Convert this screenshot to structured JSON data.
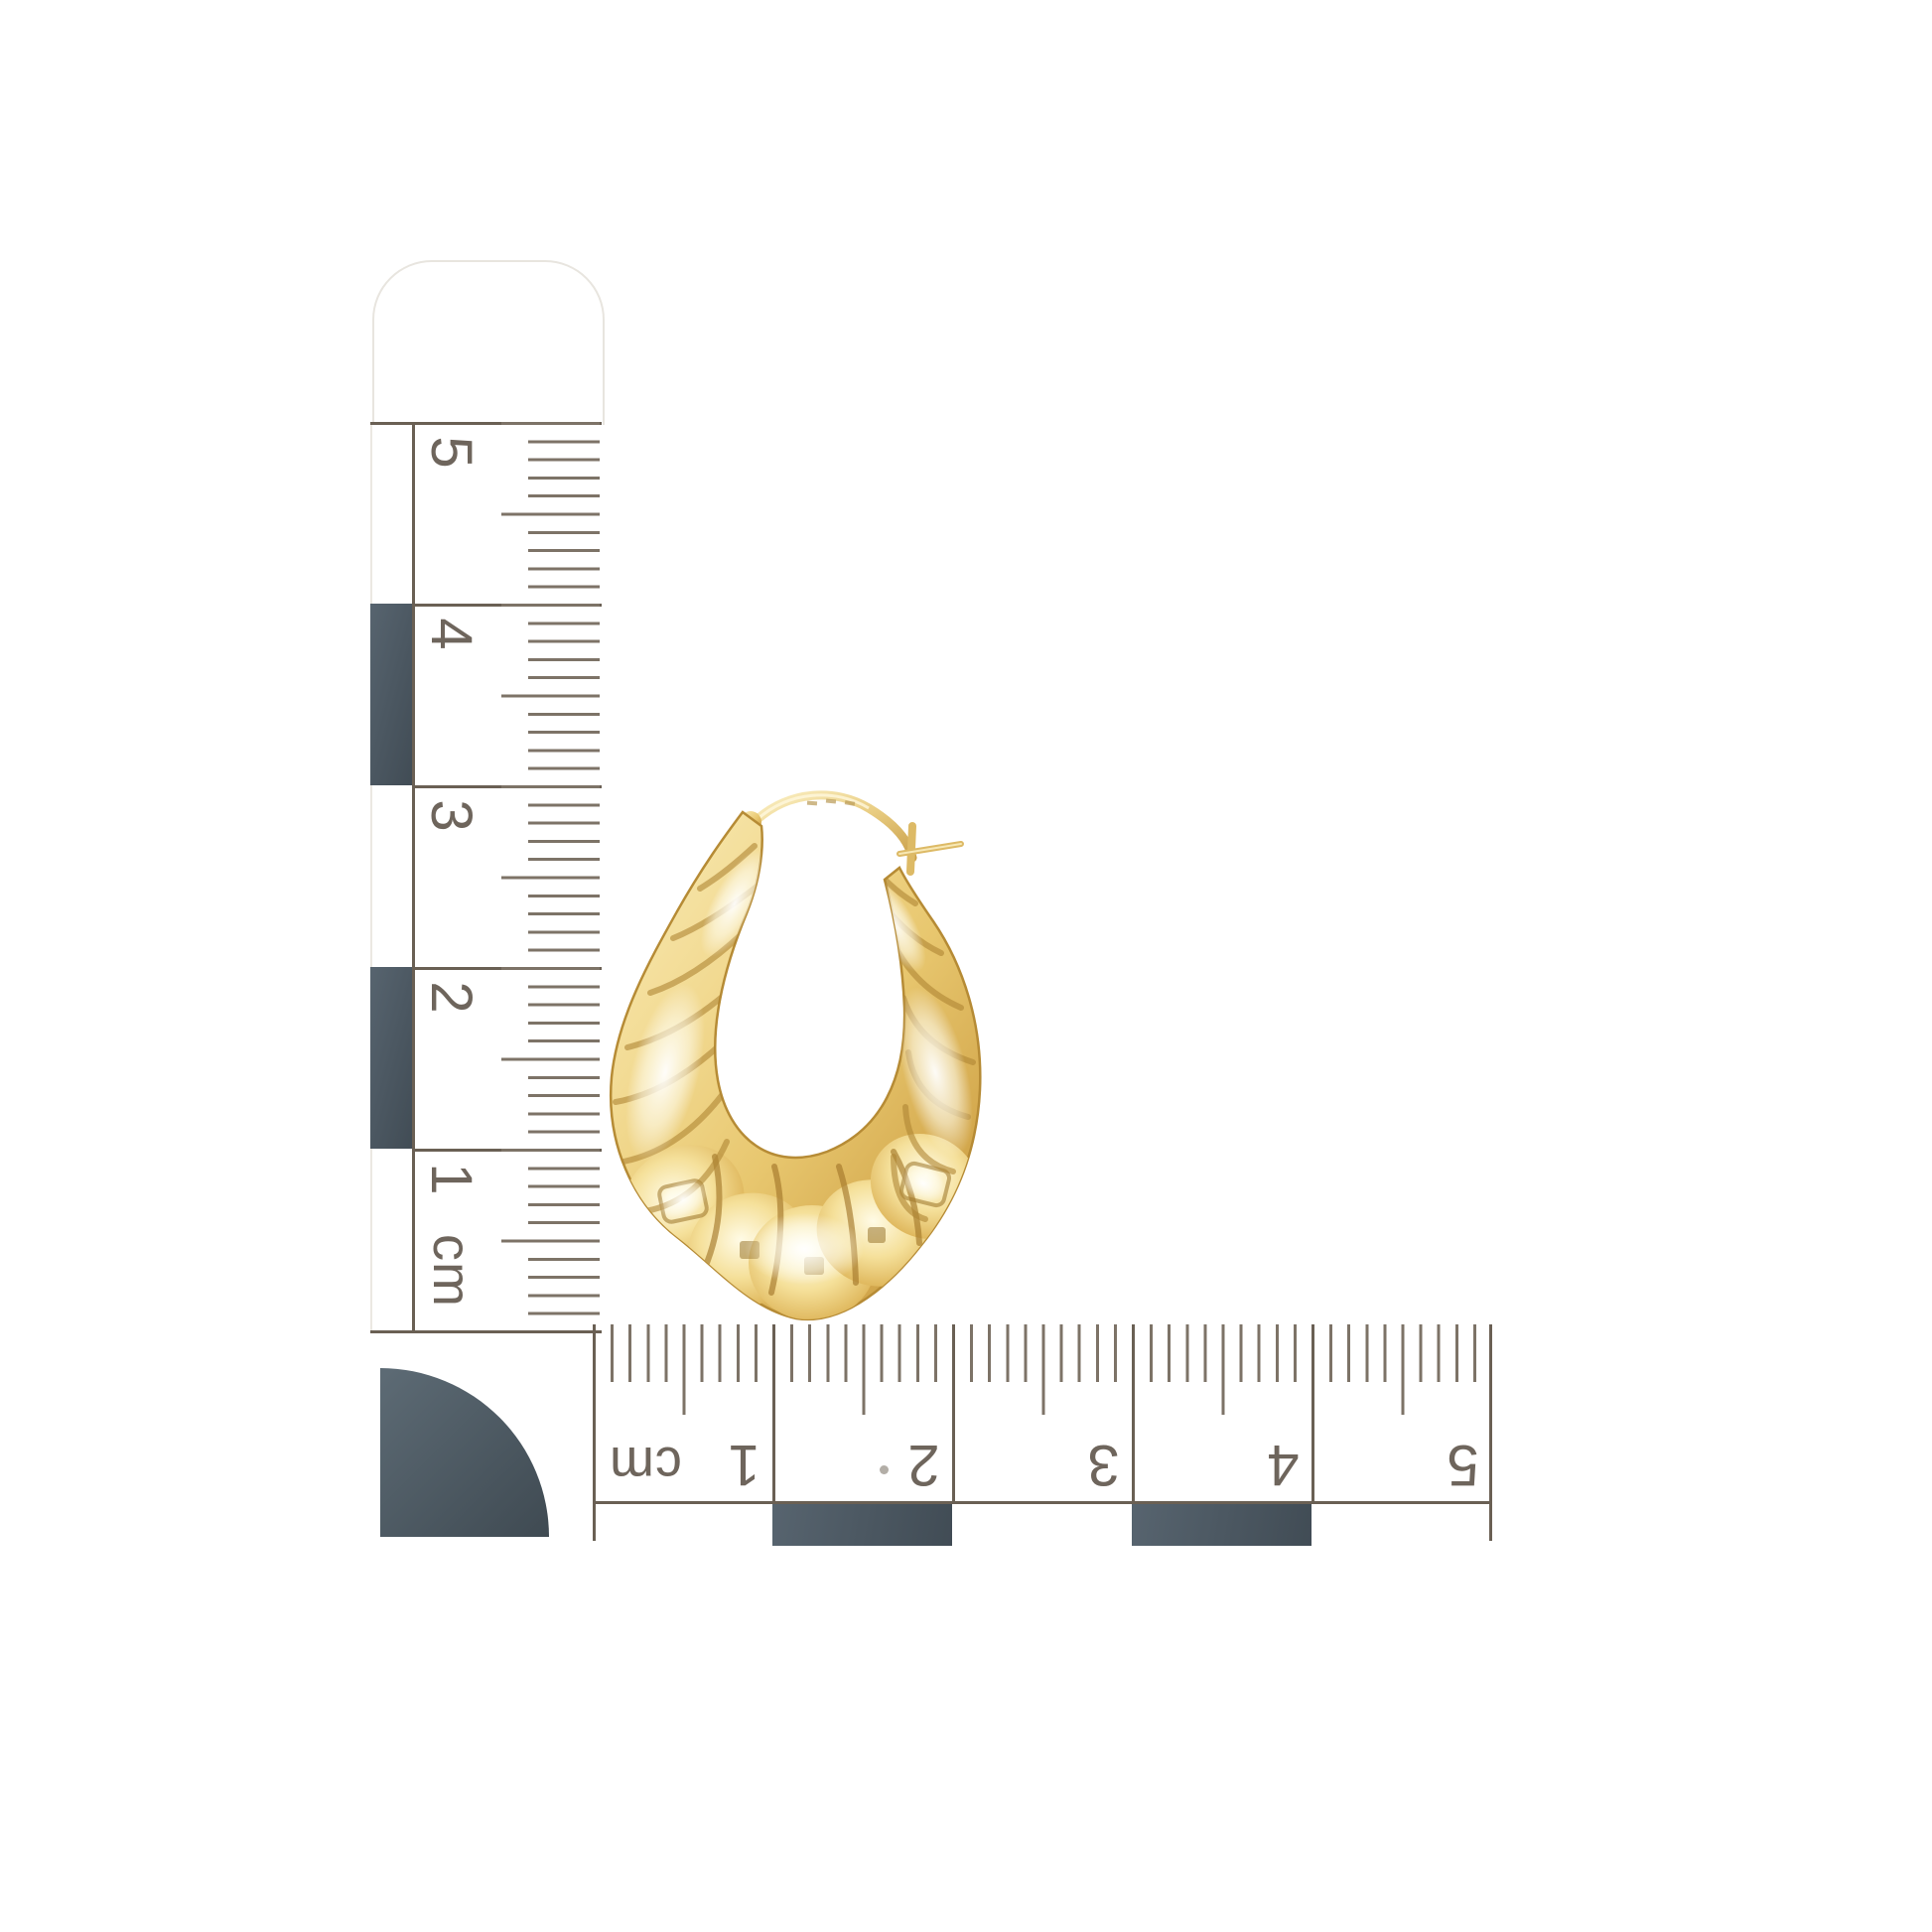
{
  "photo": {
    "subject": "Yellow gold scalloped creole shrimp hoop earring photographed on white with centimetre scale rulers",
    "background_color": "#ffffff"
  },
  "vertical_ruler": {
    "orientation": "vertical",
    "unit": "cm",
    "labels": [
      "5",
      "4",
      "3",
      "2",
      "1",
      "cm"
    ]
  },
  "horizontal_ruler": {
    "orientation": "horizontal",
    "unit": "cm",
    "labels": [
      "cm",
      "1",
      "2",
      "3",
      "4",
      "5"
    ]
  },
  "colors": {
    "ruler_ink": "#6a6054",
    "ruler_tick": "#7d7367",
    "ruler_number": "#6e655c",
    "scale_block_dark": "#4a5560",
    "gold_light": "#f9ecb8",
    "gold_mid": "#e8c76f",
    "gold_deep": "#bd8f36"
  }
}
